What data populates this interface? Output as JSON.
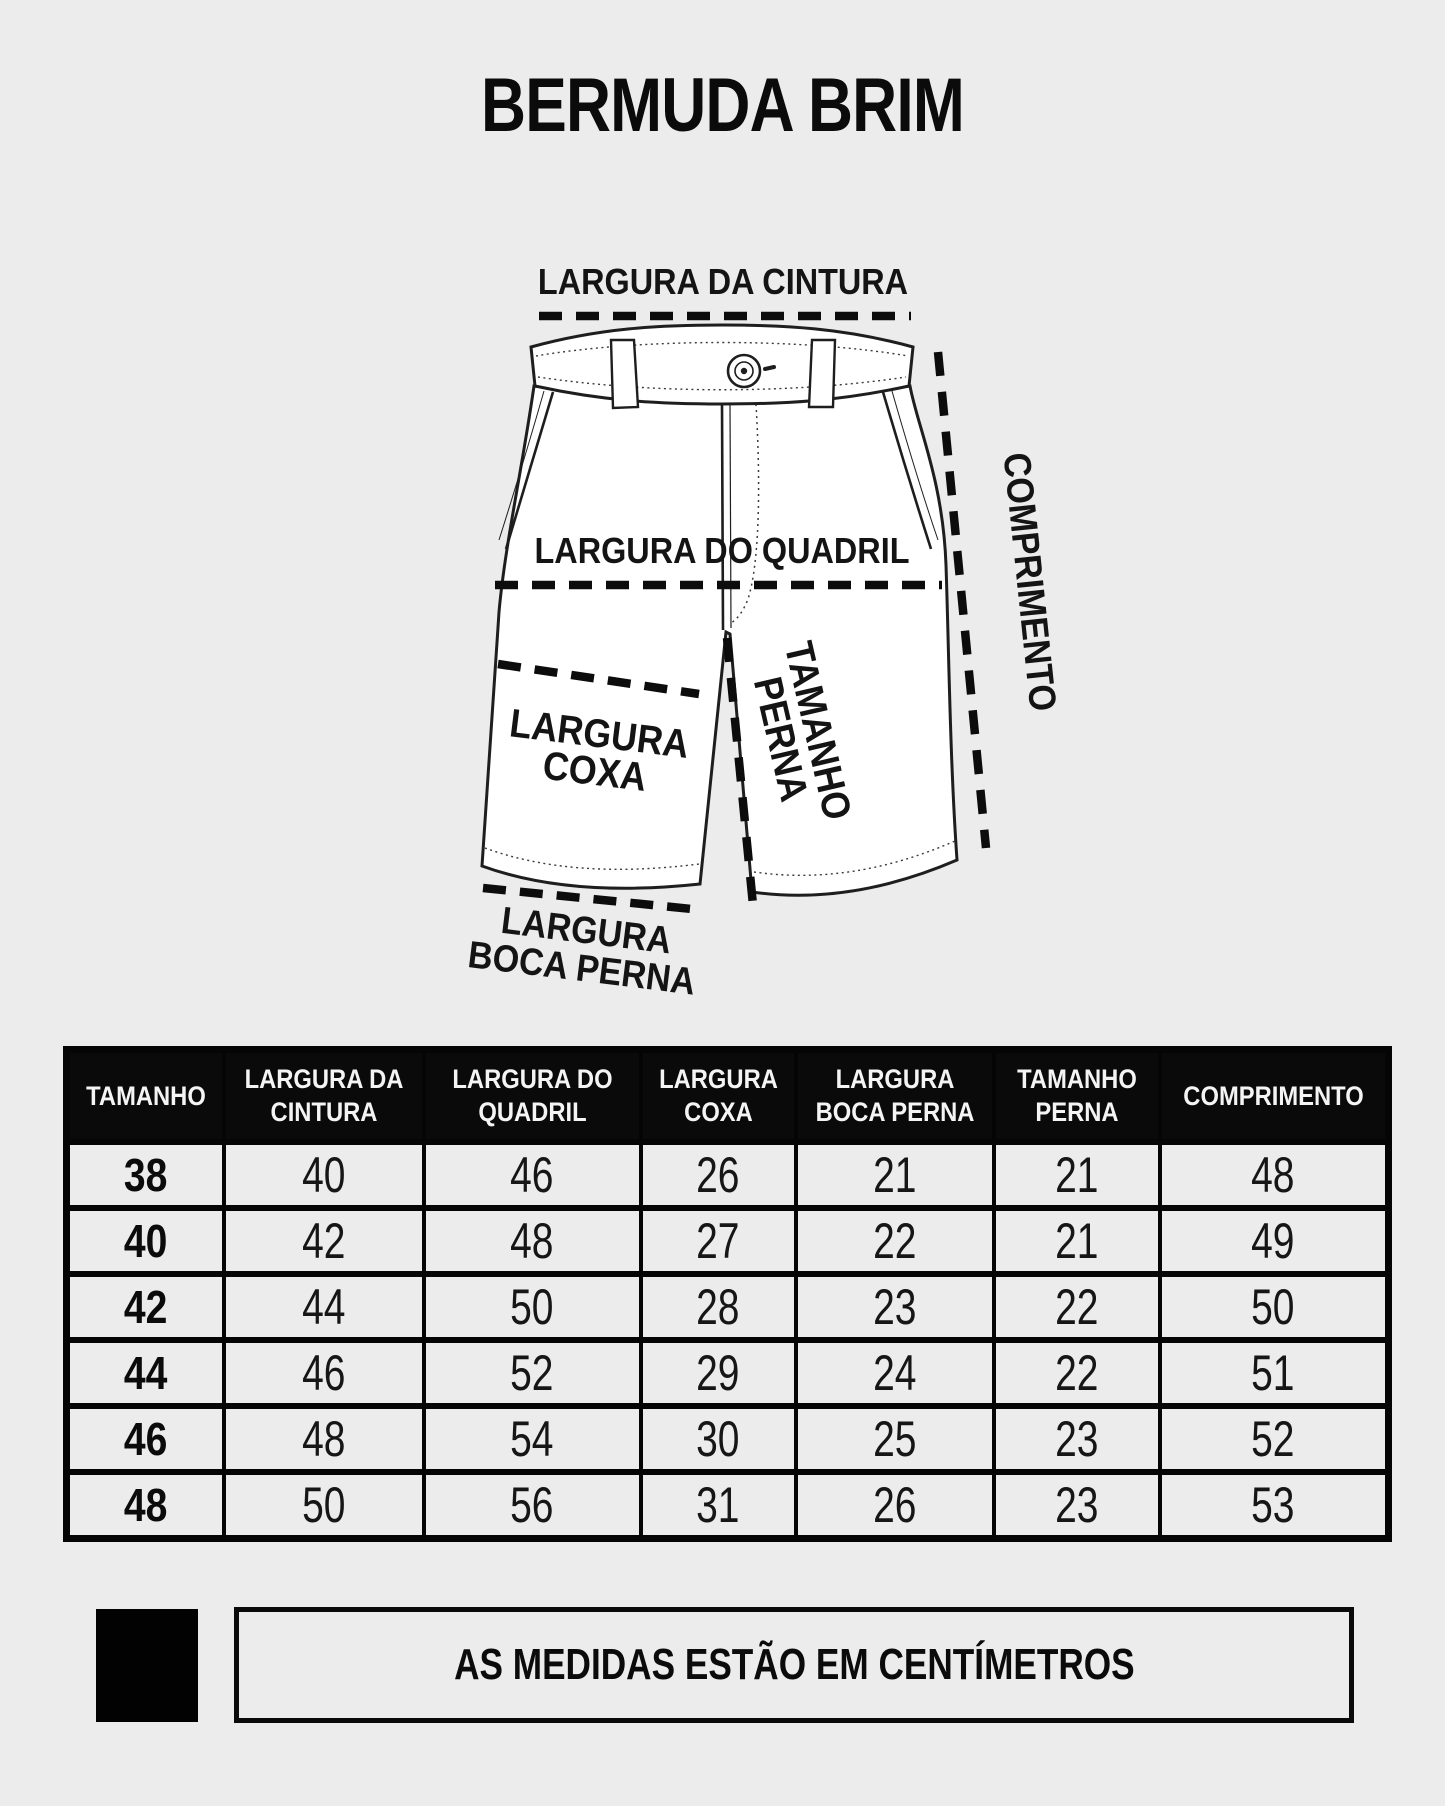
{
  "page": {
    "title": "BERMUDA BRIM",
    "background_color": "#ececec",
    "ink_color": "#0d0d0d"
  },
  "diagram": {
    "drawing": "shorts-front-technical-sketch",
    "labels": {
      "waist": "LARGURA DA CINTURA",
      "hip": "LARGURA DO QUADRIL",
      "thigh_line1": "LARGURA",
      "thigh_line2": "COXA",
      "inseam_line1": "TAMANHO",
      "inseam_line2": "PERNA",
      "length": "COMPRIMENTO",
      "hem_line1": "LARGURA",
      "hem_line2": "BOCA PERNA"
    }
  },
  "table": {
    "header_bg": "#0a0a0a",
    "header_text_color": "#f4f4f4",
    "columns": [
      "TAMANHO",
      "LARGURA DA CINTURA",
      "LARGURA DO QUADRIL",
      "LARGURA COXA",
      "LARGURA BOCA PERNA",
      "TAMANHO PERNA",
      "COMPRIMENTO"
    ],
    "rows": [
      {
        "size": "38",
        "values": [
          "40",
          "46",
          "26",
          "21",
          "21",
          "48"
        ]
      },
      {
        "size": "40",
        "values": [
          "42",
          "48",
          "27",
          "22",
          "21",
          "49"
        ]
      },
      {
        "size": "42",
        "values": [
          "44",
          "50",
          "28",
          "23",
          "22",
          "50"
        ]
      },
      {
        "size": "44",
        "values": [
          "46",
          "52",
          "29",
          "24",
          "22",
          "51"
        ]
      },
      {
        "size": "46",
        "values": [
          "48",
          "54",
          "30",
          "25",
          "23",
          "52"
        ]
      },
      {
        "size": "48",
        "values": [
          "50",
          "56",
          "31",
          "26",
          "23",
          "53"
        ]
      }
    ]
  },
  "note": {
    "text": "AS MEDIDAS ESTÃO EM CENTÍMETROS"
  }
}
